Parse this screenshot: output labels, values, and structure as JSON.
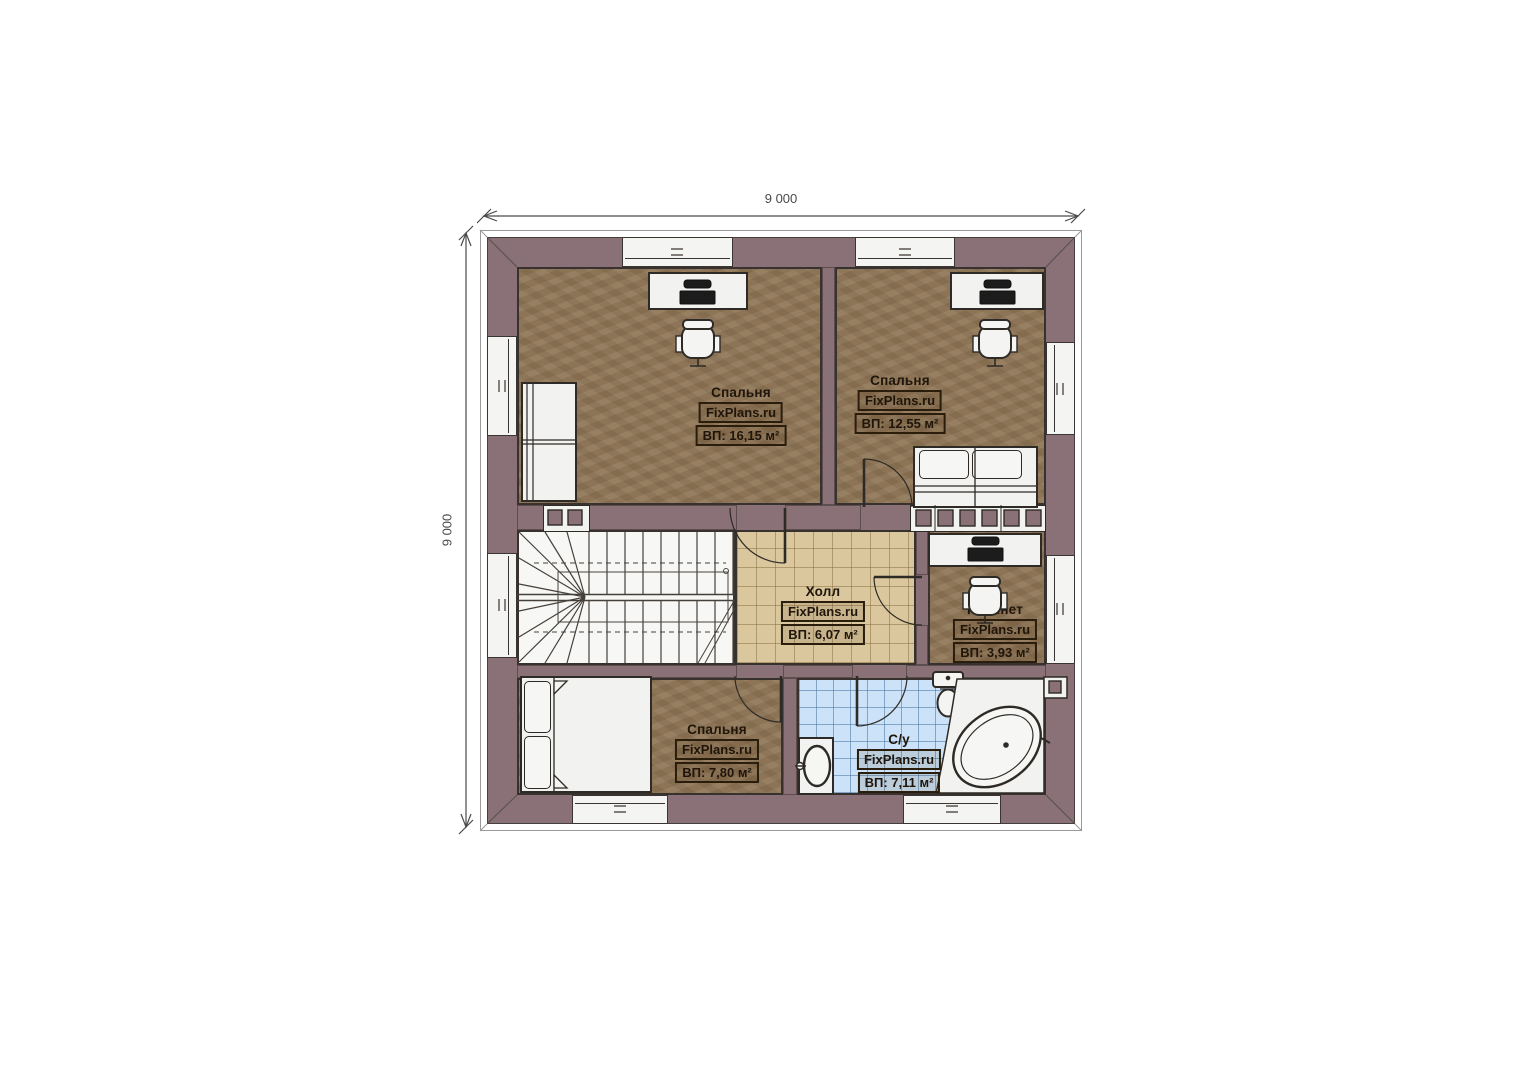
{
  "dimensions": {
    "top": "9 000",
    "left": "9 000"
  },
  "rooms": {
    "bedroom_top_left": {
      "name": "Спальня",
      "brand": "FixPlans.ru",
      "area": "ВП: 16,15 м²"
    },
    "bedroom_top_right": {
      "name": "Спальня",
      "brand": "FixPlans.ru",
      "area": "ВП: 12,55 м²"
    },
    "hall": {
      "name": "Холл",
      "brand": "FixPlans.ru",
      "area": "ВП: 6,07 м²"
    },
    "office": {
      "name": "Кабинет",
      "brand": "FixPlans.ru",
      "area": "ВП: 3,93 м²"
    },
    "bedroom_bottom_left": {
      "name": "Спальня",
      "brand": "FixPlans.ru",
      "area": "ВП: 7,80 м²"
    },
    "bathroom": {
      "name": "С/у",
      "brand": "FixPlans.ru",
      "area": "ВП: 7,11 м²"
    }
  },
  "colors": {
    "wall": "#8a7077",
    "bedroom_floor": "#8d7456",
    "hall_floor": "#dac79e",
    "bathroom_floor": "#cbe2f8",
    "furniture": "#f2f2f0",
    "outline": "#38322f"
  }
}
